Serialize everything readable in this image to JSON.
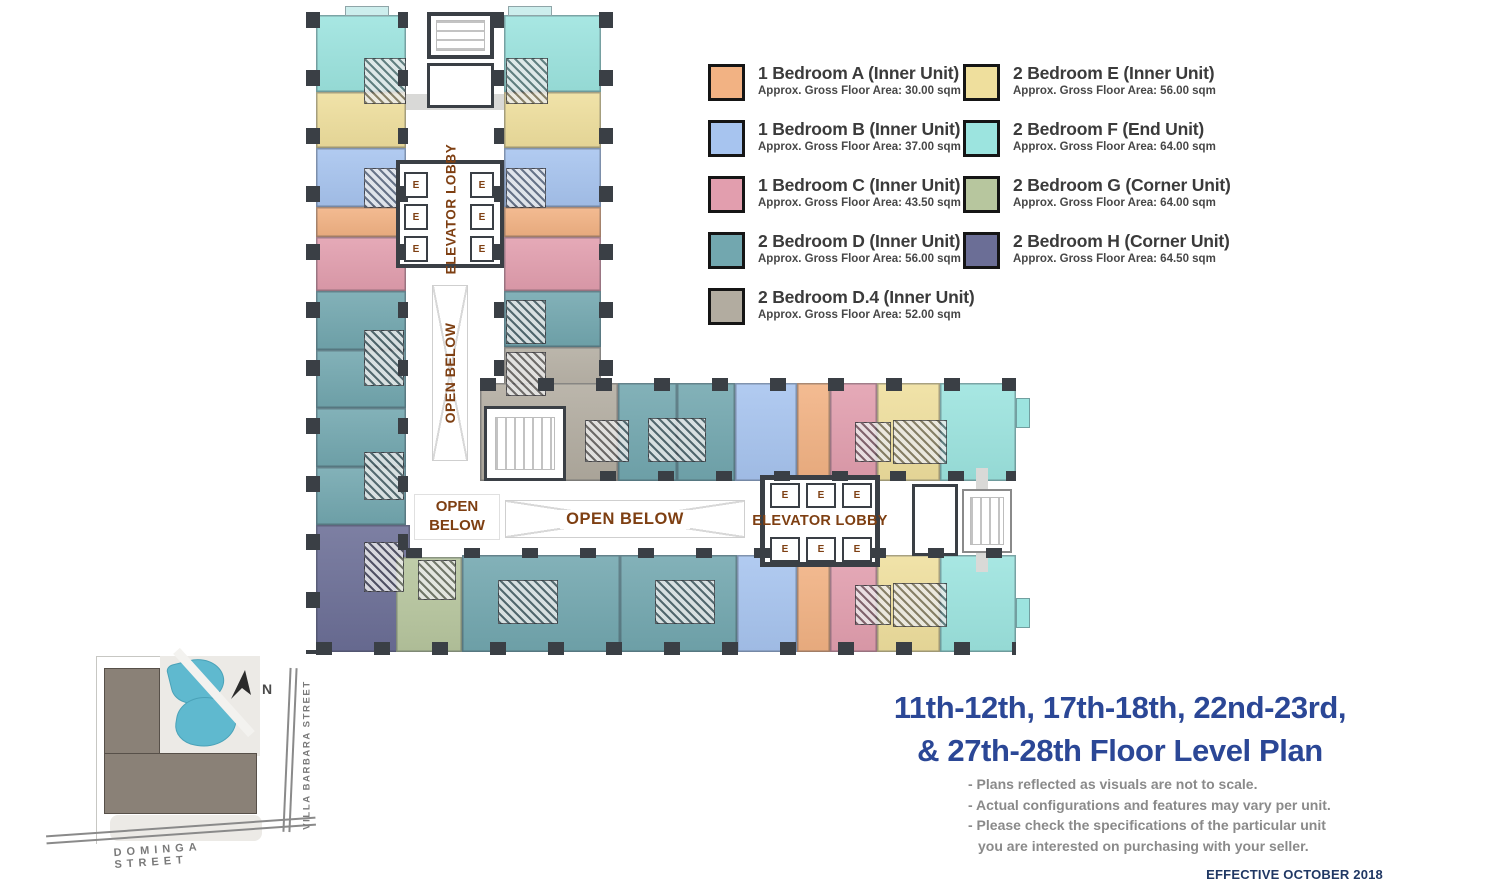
{
  "legend": {
    "items": [
      {
        "code": "A",
        "label": "1 Bedroom A (Inner Unit)",
        "area": "Approx. Gross Floor Area: 30.00 sqm",
        "color": "#F2B283"
      },
      {
        "code": "B",
        "label": "1 Bedroom B (Inner Unit)",
        "area": "Approx. Gross Floor Area: 37.00 sqm",
        "color": "#A7C4EF"
      },
      {
        "code": "C",
        "label": "1 Bedroom C (Inner Unit)",
        "area": "Approx. Gross Floor Area: 43.50 sqm",
        "color": "#E29EAE"
      },
      {
        "code": "D",
        "label": "2 Bedroom D (Inner Unit)",
        "area": "Approx. Gross Floor Area: 56.00 sqm",
        "color": "#72A7AF"
      },
      {
        "code": "D4",
        "label": "2 Bedroom D.4 (Inner Unit)",
        "area": "Approx. Gross Floor Area: 52.00 sqm",
        "color": "#B2ACA0"
      },
      {
        "code": "E",
        "label": "2 Bedroom E (Inner Unit)",
        "area": "Approx. Gross Floor Area: 56.00 sqm",
        "color": "#EFDF9D"
      },
      {
        "code": "F",
        "label": "2 Bedroom F (End Unit)",
        "area": "Approx. Gross Floor Area: 64.00 sqm",
        "color": "#9CE4DF"
      },
      {
        "code": "G",
        "label": "2 Bedroom G (Corner Unit)",
        "area": "Approx. Gross Floor Area: 64.00 sqm",
        "color": "#B7C69E"
      },
      {
        "code": "H",
        "label": "2 Bedroom H (Corner Unit)",
        "area": "Approx. Gross Floor Area: 64.50 sqm",
        "color": "#6B6E96"
      }
    ]
  },
  "plan": {
    "elevator_lobby": "ELEVATOR LOBBY",
    "open_below": "OPEN BELOW",
    "elevator_cell": "E"
  },
  "site_map": {
    "north": "N",
    "street_side": "VILLA BARBARA STREET",
    "street_bottom": "DOMINGA STREET"
  },
  "title_block": {
    "line1": "11th-12th, 17th-18th, 22nd-23rd,",
    "line2": "& 27th-28th Floor Level Plan",
    "notes": [
      "- Plans reflected as visuals are not to scale.",
      "- Actual configurations and features may vary per unit.",
      "- Please check the specifications of the particular unit",
      "you are interested on purchasing with your seller."
    ],
    "effective": "EFFECTIVE OCTOBER 2018"
  },
  "colors": {
    "label_brown": "#7E3F12",
    "title_blue": "#2B4796",
    "notes_gray": "#8A8A8A",
    "effective_navy": "#203864",
    "wall_dark": "#3A3F45",
    "building_gray": "#8A8177",
    "pool_blue": "#5FB9CF"
  }
}
